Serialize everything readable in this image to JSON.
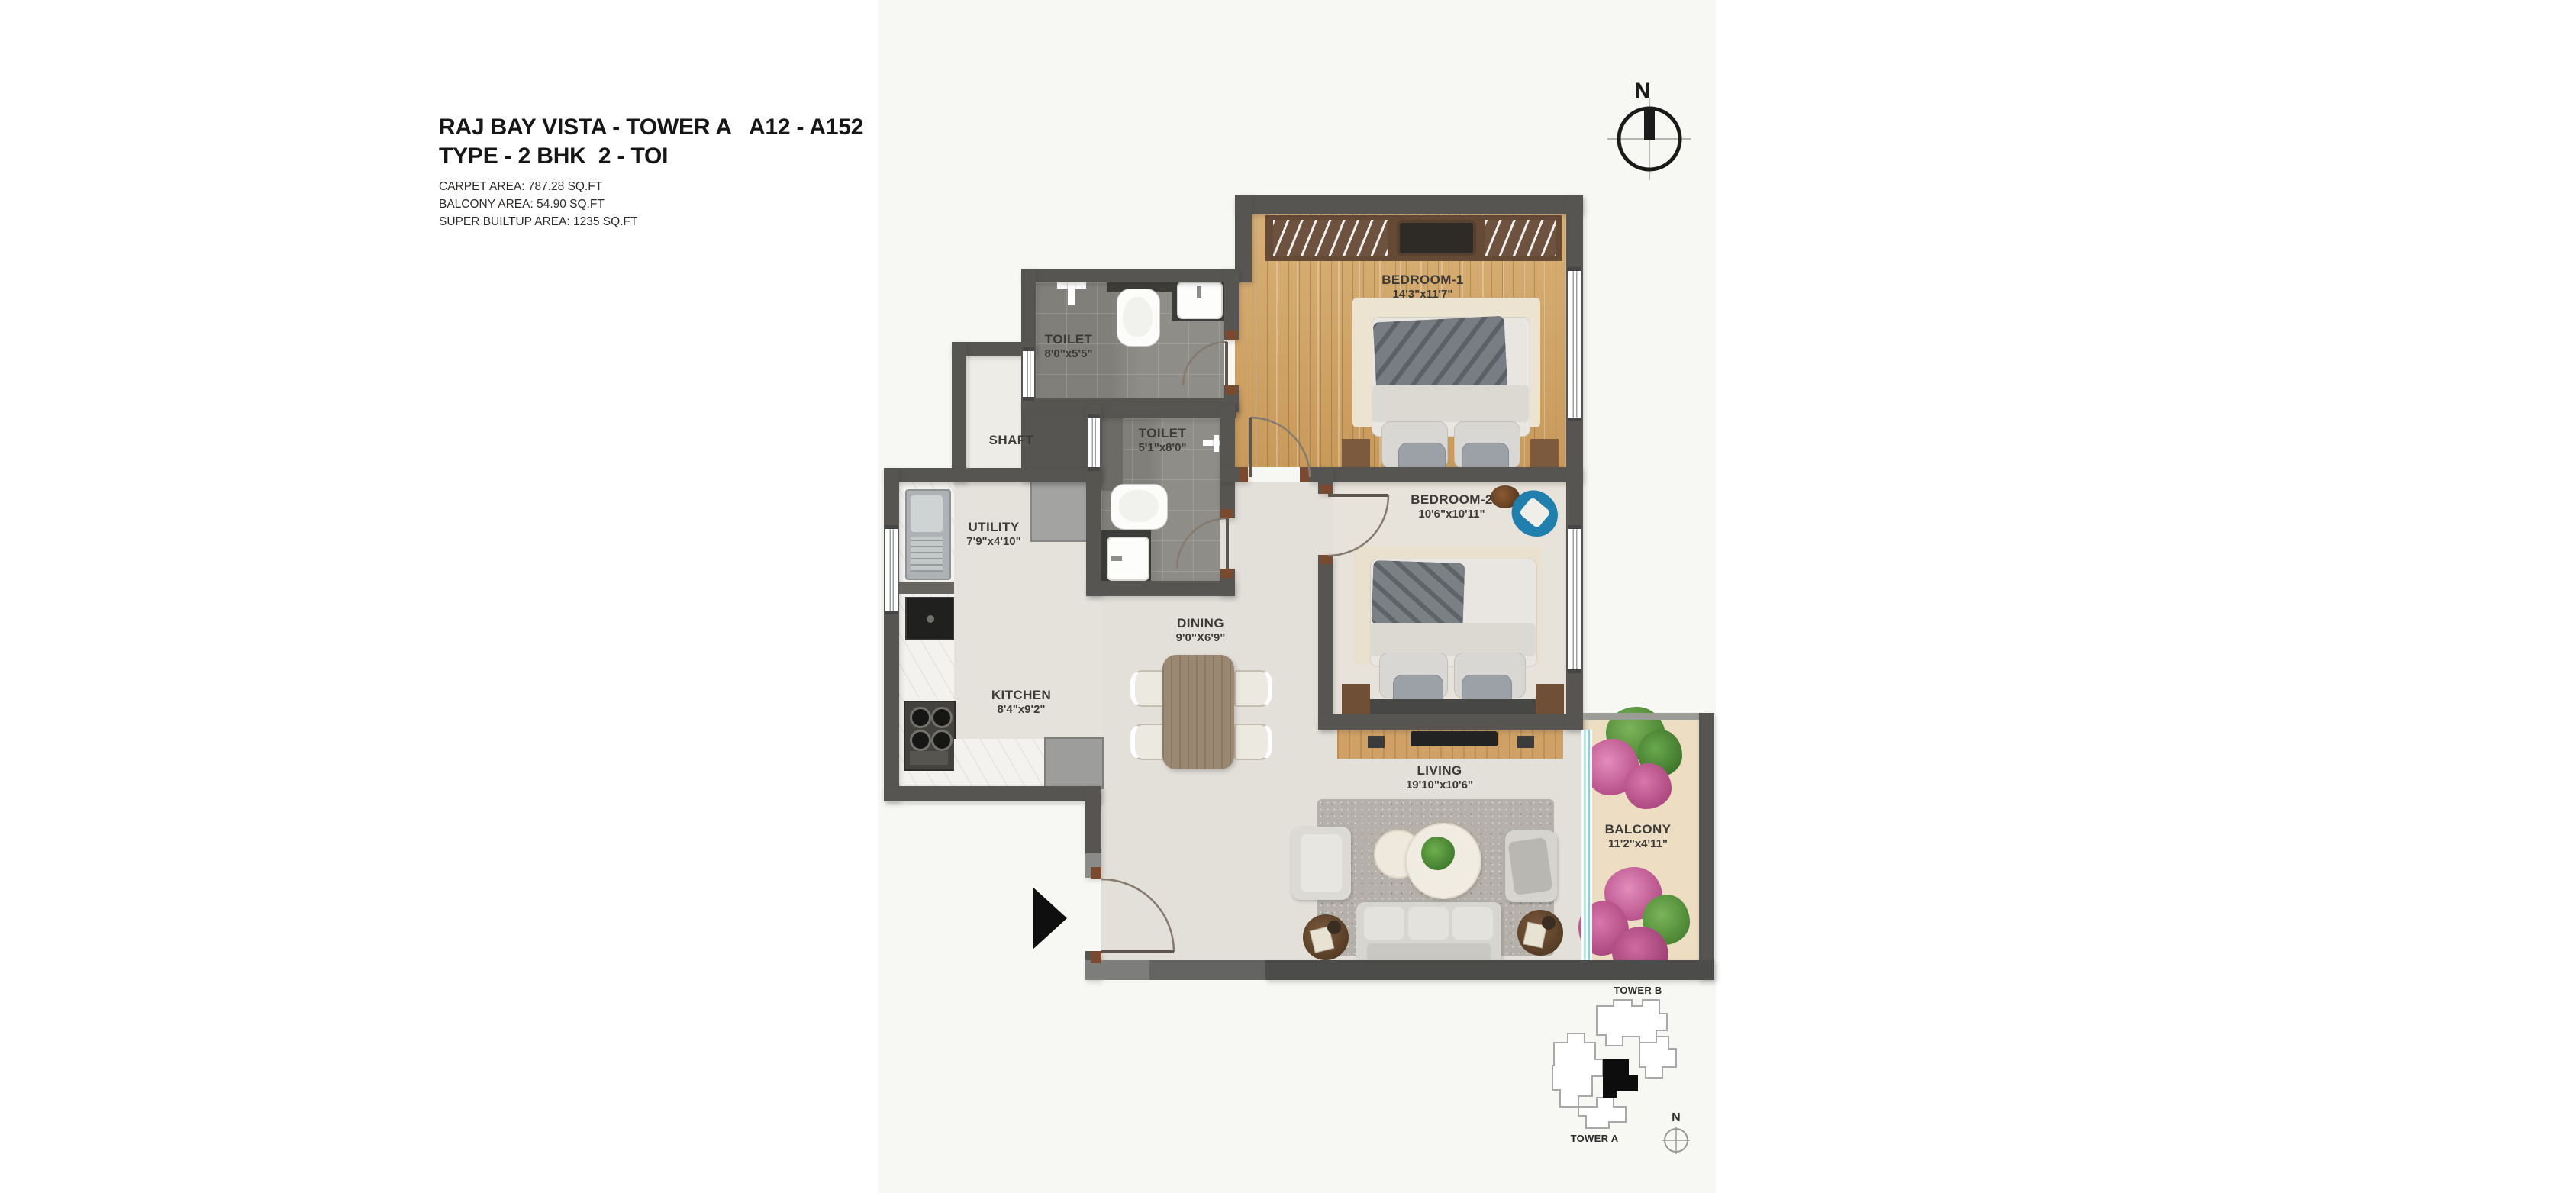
{
  "title": {
    "line1": "RAJ BAY VISTA - TOWER A   A12 - A152",
    "line2": "TYPE - 2 BHK  2 - TOI"
  },
  "areas": {
    "carpet": "CARPET AREA: 787.28 SQ.FT",
    "balcony": "BALCONY AREA: 54.90 SQ.FT",
    "super_builtup": "SUPER BUILTUP AREA: 1235 SQ.FT"
  },
  "compass": {
    "label": "N"
  },
  "rooms": {
    "bedroom1": {
      "name": "BEDROOM-1",
      "dim": "14'3\"x11'7\""
    },
    "bedroom2": {
      "name": "BEDROOM-2",
      "dim": "10'6\"x10'11\""
    },
    "toilet1": {
      "name": "TOILET",
      "dim": "8'0\"x5'5\""
    },
    "toilet2": {
      "name": "TOILET",
      "dim": "5'1\"x8'0\""
    },
    "shaft": {
      "name": "SHAFT"
    },
    "utility": {
      "name": "UTILITY",
      "dim": "7'9\"x4'10\""
    },
    "kitchen": {
      "name": "KITCHEN",
      "dim": "8'4\"x9'2\""
    },
    "dining": {
      "name": "DINING",
      "dim": "9'0\"X6'9\""
    },
    "living": {
      "name": "LIVING",
      "dim": "19'10\"x10'6\""
    },
    "balcony": {
      "name": "BALCONY",
      "dim": "11'2\"x4'11\""
    }
  },
  "minimap": {
    "tower_b": "TOWER B",
    "tower_a": "TOWER A",
    "compass": "N"
  },
  "colors": {
    "wall": "#575551",
    "wood_floor": "#cfa462",
    "toilet_tile": "#8f8d88",
    "balcony_floor": "#edddc2",
    "flower_pink": "#c9609b",
    "accent_blue": "#2a7ea8"
  }
}
